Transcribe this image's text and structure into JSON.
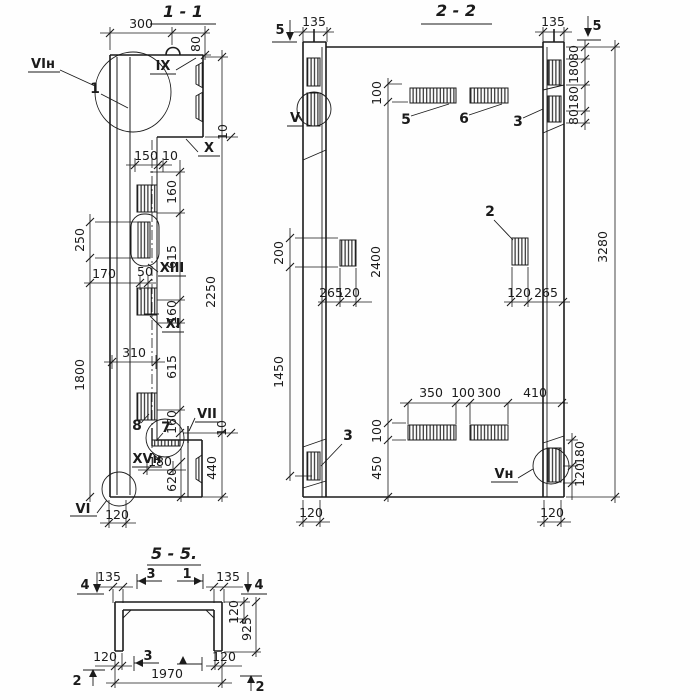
{
  "meta": {
    "background": "#fefefe",
    "ink": "#1b1b1b",
    "drawing_type": "reinforced concrete panel sections"
  },
  "s1": {
    "title": "1 - 1",
    "marks": {
      "vin": "VIн",
      "ix": "IX",
      "x": "X",
      "xiii": "XIII",
      "xi": "XI",
      "vii": "VII",
      "xvn": "XVн",
      "vi": "VI"
    },
    "callouts": {
      "p1": "1",
      "p7": "7",
      "p8": "8"
    },
    "dims": {
      "d300": "300",
      "d80": "80",
      "d150": "150",
      "d10a": "10",
      "d10b": "10",
      "d10c": "10",
      "c160a": "160",
      "c615a": "615",
      "c160b": "160",
      "c615b": "615",
      "c160c": "160",
      "d2250": "2250",
      "d250": "250",
      "d170": "170",
      "d50": "50",
      "d310": "310",
      "d1800": "1800",
      "d120": "120",
      "d180": "180",
      "d620": "620",
      "d440": "440"
    }
  },
  "s2": {
    "title": "2 - 2",
    "marks": {
      "v": "V",
      "vn": "Vн",
      "cut5l": "5",
      "cut5r": "5"
    },
    "callouts": {
      "p5": "5",
      "p6": "6",
      "p3t": "3",
      "p3b": "3",
      "p2": "2"
    },
    "dims": {
      "d135l": "135",
      "d135r": "135",
      "r80a": "80",
      "r180a": "180",
      "r180b": "180",
      "r80b": "80",
      "d3280": "3280",
      "d200": "200",
      "d1450": "1450",
      "d100t": "100",
      "d2400": "2400",
      "d100b": "100",
      "d450": "450",
      "d265l": "265",
      "d120l": "120",
      "d120r": "120",
      "d265r": "265",
      "d350": "350",
      "d100c": "100",
      "d300": "300",
      "d410": "410",
      "rb180": "180",
      "rb120": "120",
      "f120l": "120",
      "f120r": "120"
    }
  },
  "s5": {
    "title": "5 - 5.",
    "marks": {
      "c4l": "4",
      "c4r": "4",
      "c3t": "3",
      "c1t": "1",
      "c3b": "3",
      "c2l": "2",
      "c2r": "2"
    },
    "dims": {
      "d135l": "135",
      "d135r": "135",
      "d120r": "120",
      "d925": "925",
      "b120l": "120",
      "b120r": "120",
      "d1970": "1970"
    }
  }
}
